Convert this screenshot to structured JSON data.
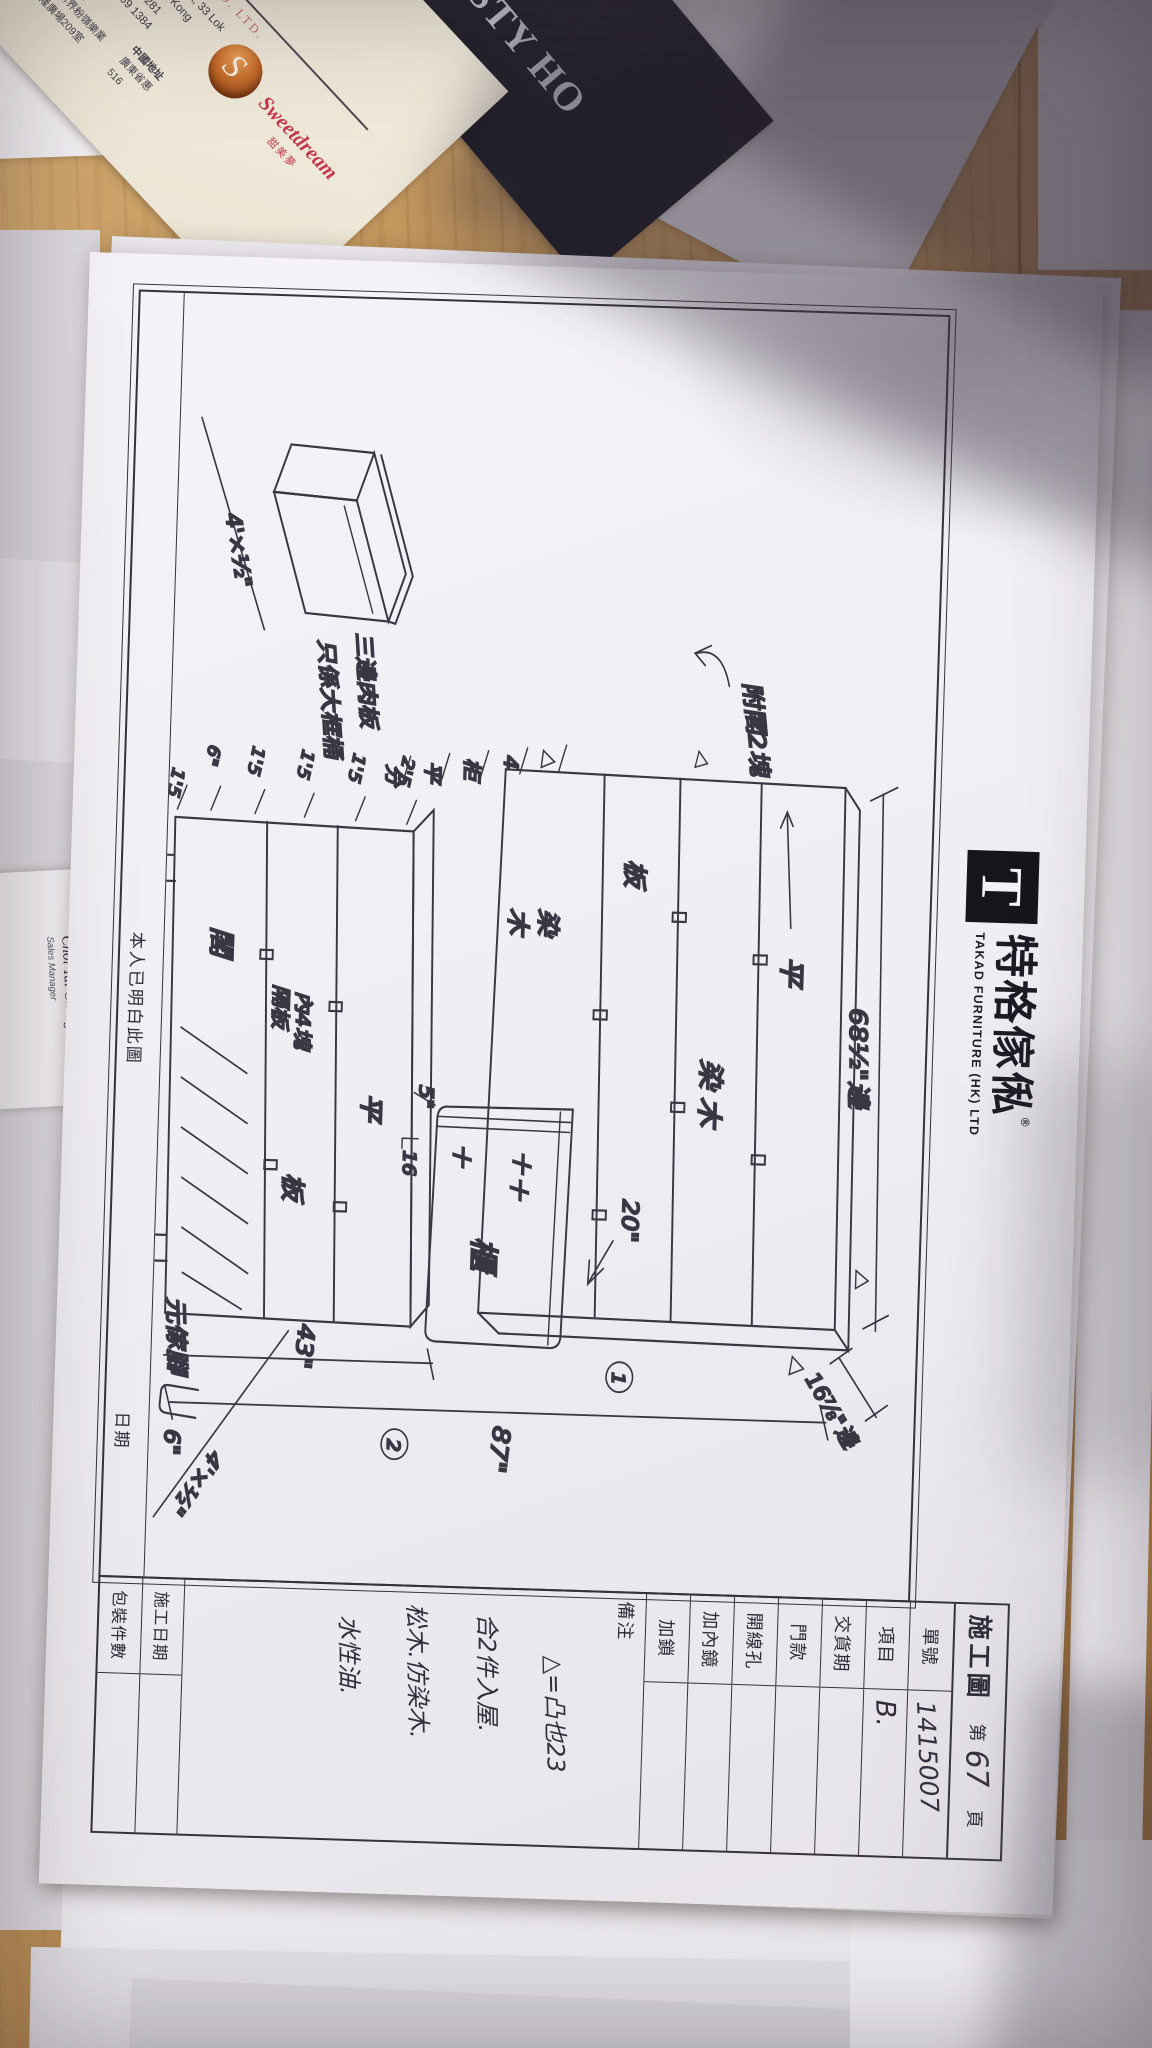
{
  "photo": {
    "colors": {
      "desk_wood": "#b6894f",
      "paper": "#f0eef3",
      "ink": "#35313d",
      "shadow": "rgba(48,40,54,0.40)"
    },
    "top_right_paper": {
      "lines": [
        "乂慢線",
        "279548"
      ]
    },
    "bottom_right_paper": {
      "lines": [
        "慢線",
        "279548",
        "地下2 號舖",
        "187-191號",
        "二座商場B22號舖",
        "B12號舖",
        "地舖",
        "C.B 座地下5",
        "地舖至3樓",
        "舖"
      ]
    }
  },
  "cards": {
    "sweetdream": {
      "company_cn": "廠有限公司",
      "company_en": "TRESSES MFG. CO. LTD.",
      "brand": "Sweetdream",
      "brand_cn": "甜美夢",
      "logo_s": "S",
      "address_line1": "209 Hong Leong Plaza, 33 Lok",
      "address_line2": "Fanling, N.T., Hong Kong",
      "tel": "Tel: (852)2682 4281",
      "fax": "Fax: (852)2669 1384",
      "hk_label": "香港地址",
      "hk_line1": "香港新界粉嶺樂業",
      "hk_line2": "豐隆廣場209室",
      "cn_label": "中國地址",
      "cn_line1": "廣東省惠",
      "cn_line2": "516"
    },
    "dynasty": {
      "name_visible": "NASTY HO"
    },
    "peter": {
      "name": "Peter Hoi",
      "title": "Sales Manager",
      "number": "1189"
    },
    "choi": {
      "name_cn": "蔡大清",
      "name_en": "Choi Tai Cheng",
      "title": "Sales Manager"
    }
  },
  "sheet": {
    "header": {
      "logo_t": "T",
      "logo_cn": "特格傢俬",
      "logo_reg": "®",
      "logo_en": "TAKAD FURNITURE (HK) LTD",
      "title": "施工圖",
      "page_prefix": "第",
      "page_number": "67",
      "page_suffix": "頁"
    },
    "info_table": [
      {
        "label": "單號",
        "value": "1415007"
      },
      {
        "label": "項目",
        "value": "B."
      },
      {
        "label": "交貨期",
        "value": ""
      },
      {
        "label": "門款",
        "value": ""
      },
      {
        "label": "開線孔",
        "value": ""
      },
      {
        "label": "加內鏡",
        "value": ""
      },
      {
        "label": "加鎖",
        "value": ""
      }
    ],
    "remarks": {
      "label": "備注",
      "lines": [
        "△=凸也23",
        "合2件入屋.",
        "松木.仿染木.",
        "水性油."
      ]
    },
    "schedule_table": [
      {
        "label": "施工日期",
        "value": ""
      },
      {
        "label": "包裝件數",
        "value": ""
      }
    ],
    "footer": {
      "statement": "本人已明白此圖",
      "date_label": "日期"
    },
    "drawing": {
      "dimensions": {
        "width_top": "68½\"邊",
        "depth_side": "16⅞\"邊",
        "height_total": "87\"",
        "height_chest": "43\"",
        "recess": "20\"",
        "gap": "5\"",
        "n16": "16",
        "panel_top": "4'×½\"",
        "panel_bottom": "4'×½\"",
        "foot_height": "6\""
      },
      "edge_ticks": [
        "2'5",
        "1'5",
        "1'5",
        "1'5",
        "6\"",
        "1'5"
      ],
      "spacing_marks": [
        "4",
        "柜",
        "平",
        "分"
      ],
      "wardrobe_labels": {
        "shelf1": "平",
        "shelf2": "染木",
        "shelf3": "板",
        "bottom1": "染",
        "bottom2": "木"
      },
      "dresser": {
        "label": "櫃",
        "cross1": "十",
        "cross2": "十",
        "cross3": "十"
      },
      "ch_labels": {
        "row1": "平",
        "row2_board": "板",
        "row2_inner1": "內4塊",
        "row2_inner2": "隔板",
        "row3": "閣"
      },
      "notes": {
        "attic": "附閣2塊",
        "small_box1": "三邊肉板",
        "small_box2": "只係大框桶",
        "foot": "元傢腳"
      },
      "circled": {
        "c1": "1",
        "c2": "2"
      }
    }
  }
}
